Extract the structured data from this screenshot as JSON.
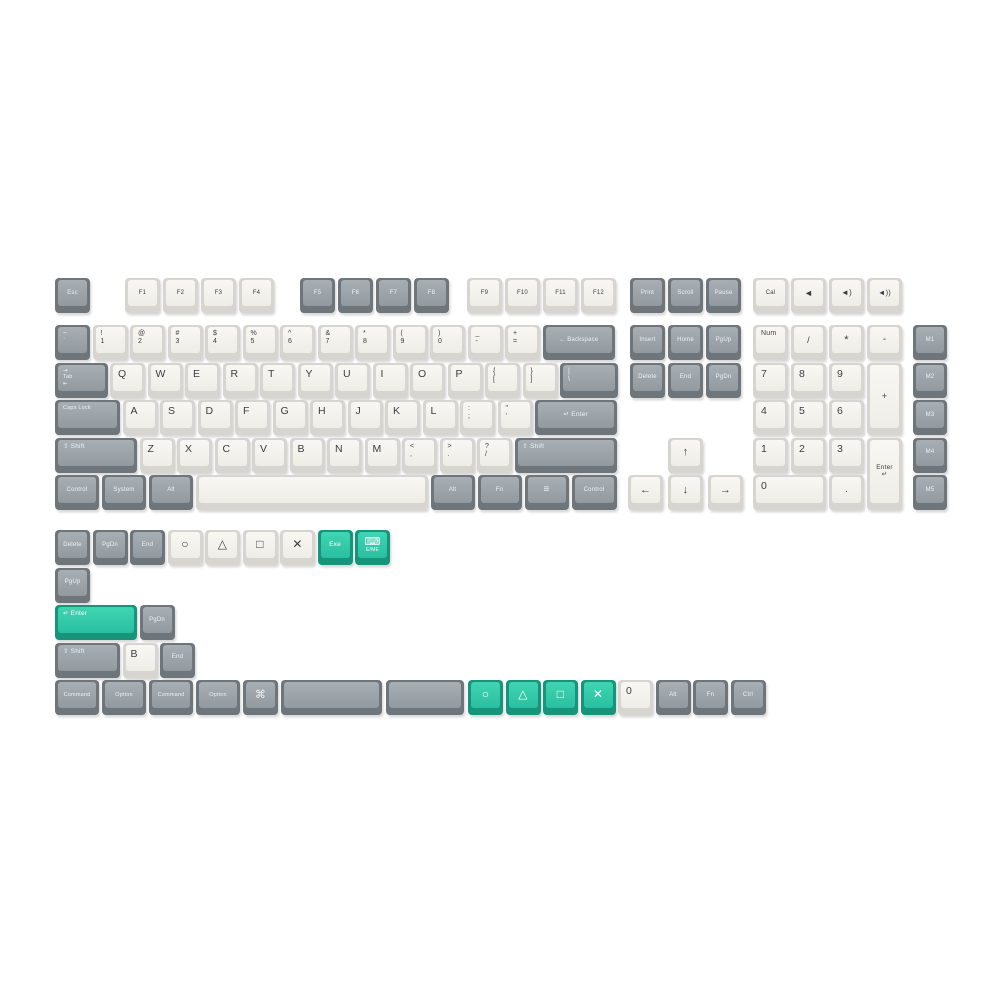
{
  "page": {
    "background": "#ffffff",
    "description_colors": {
      "white_key_top": "#f4f3ee",
      "white_key_side": "#d6d5cf",
      "gray_key_top": "#9aa1a7",
      "gray_key_side": "#6e757b",
      "teal_key_top": "#2fc8a6",
      "teal_key_side": "#17957a",
      "legend_dark": "#3b3e41",
      "legend_light": "#eef1f2"
    }
  },
  "keys": [
    {
      "id": "esc",
      "l": "Esc",
      "x": 55,
      "y": 278,
      "c": "gray"
    },
    {
      "id": "f1",
      "l": "F1",
      "x": 125,
      "y": 278,
      "c": "white"
    },
    {
      "id": "f2",
      "l": "F2",
      "x": 163,
      "y": 278,
      "c": "white"
    },
    {
      "id": "f3",
      "l": "F3",
      "x": 201,
      "y": 278,
      "c": "white"
    },
    {
      "id": "f4",
      "l": "F4",
      "x": 239,
      "y": 278,
      "c": "white"
    },
    {
      "id": "f5",
      "l": "F5",
      "x": 300,
      "y": 278,
      "c": "gray"
    },
    {
      "id": "f6",
      "l": "F6",
      "x": 338,
      "y": 278,
      "c": "gray"
    },
    {
      "id": "f7",
      "l": "F7",
      "x": 376,
      "y": 278,
      "c": "gray"
    },
    {
      "id": "f8",
      "l": "F8",
      "x": 414,
      "y": 278,
      "c": "gray"
    },
    {
      "id": "f9",
      "l": "F9",
      "x": 467,
      "y": 278,
      "c": "white"
    },
    {
      "id": "f10",
      "l": "F10",
      "x": 505,
      "y": 278,
      "c": "white"
    },
    {
      "id": "f11",
      "l": "F11",
      "x": 543,
      "y": 278,
      "c": "white"
    },
    {
      "id": "f12",
      "l": "F12",
      "x": 581,
      "y": 278,
      "c": "white"
    },
    {
      "id": "print",
      "l": "Print",
      "x": 630,
      "y": 278,
      "c": "gray"
    },
    {
      "id": "scroll",
      "l": "Scroll",
      "x": 668,
      "y": 278,
      "c": "gray"
    },
    {
      "id": "pause",
      "l": "Pause",
      "x": 706,
      "y": 278,
      "c": "gray"
    },
    {
      "id": "cal",
      "l": "Cal",
      "x": 753,
      "y": 278,
      "c": "white"
    },
    {
      "id": "vol-mute",
      "l": "◄",
      "x": 791,
      "y": 278,
      "c": "white",
      "a": "c",
      "fs": 9
    },
    {
      "id": "vol-down",
      "l": "◄)",
      "x": 829,
      "y": 278,
      "c": "white",
      "a": "c",
      "fs": 8
    },
    {
      "id": "vol-up",
      "l": "◄))",
      "x": 867,
      "y": 278,
      "c": "white",
      "a": "c",
      "fs": 7.5
    },
    {
      "id": "grave",
      "l": [
        "~",
        "`"
      ],
      "x": 55,
      "y": 325,
      "c": "gray"
    },
    {
      "id": "1",
      "l": [
        "!",
        "1"
      ],
      "x": 92.5,
      "y": 325,
      "c": "white"
    },
    {
      "id": "2",
      "l": [
        "@",
        "2"
      ],
      "x": 130,
      "y": 325,
      "c": "white"
    },
    {
      "id": "3",
      "l": [
        "#",
        "3"
      ],
      "x": 167.5,
      "y": 325,
      "c": "white"
    },
    {
      "id": "4",
      "l": [
        "$",
        "4"
      ],
      "x": 205,
      "y": 325,
      "c": "white"
    },
    {
      "id": "5",
      "l": [
        "%",
        "5"
      ],
      "x": 242.5,
      "y": 325,
      "c": "white"
    },
    {
      "id": "6",
      "l": [
        "^",
        "6"
      ],
      "x": 280,
      "y": 325,
      "c": "white"
    },
    {
      "id": "7",
      "l": [
        "&",
        "7"
      ],
      "x": 317.5,
      "y": 325,
      "c": "white"
    },
    {
      "id": "8",
      "l": [
        "*",
        "8"
      ],
      "x": 355,
      "y": 325,
      "c": "white"
    },
    {
      "id": "9",
      "l": [
        "(",
        "9"
      ],
      "x": 392.5,
      "y": 325,
      "c": "white"
    },
    {
      "id": "0",
      "l": [
        ")",
        "0"
      ],
      "x": 430,
      "y": 325,
      "c": "white"
    },
    {
      "id": "minus",
      "l": [
        "_",
        "-"
      ],
      "x": 467.5,
      "y": 325,
      "c": "white"
    },
    {
      "id": "equal",
      "l": [
        "+",
        "="
      ],
      "x": 505,
      "y": 325,
      "c": "white"
    },
    {
      "id": "backspace",
      "l": "← Backspace",
      "x": 542.5,
      "y": 325,
      "w": 72.5,
      "c": "gray"
    },
    {
      "id": "insert",
      "l": "Insert",
      "x": 630,
      "y": 325,
      "c": "gray"
    },
    {
      "id": "home",
      "l": "Home",
      "x": 668,
      "y": 325,
      "c": "gray"
    },
    {
      "id": "pgup",
      "l": "PgUp",
      "x": 706,
      "y": 325,
      "c": "gray"
    },
    {
      "id": "numlock",
      "l": "Num",
      "x": 753,
      "y": 325,
      "c": "white",
      "a": "l",
      "fs": 7
    },
    {
      "id": "np-div",
      "l": "/",
      "x": 791,
      "y": 325,
      "c": "white",
      "a": "c",
      "fs": 9
    },
    {
      "id": "np-mul",
      "l": "*",
      "x": 829,
      "y": 325,
      "c": "white",
      "a": "c",
      "fs": 11
    },
    {
      "id": "np-minus",
      "l": "-",
      "x": 867,
      "y": 325,
      "c": "white",
      "a": "c",
      "fs": 10
    },
    {
      "id": "m1",
      "l": "M1",
      "x": 913,
      "y": 325,
      "w": 34,
      "c": "gray"
    },
    {
      "id": "tab",
      "l": [
        "⇥",
        "Tab",
        "⇤"
      ],
      "x": 55,
      "y": 362.5,
      "w": 52.5,
      "c": "gray",
      "a": "l",
      "fs": 5.5
    },
    {
      "id": "q",
      "l": "Q",
      "x": 110,
      "y": 362.5,
      "c": "white"
    },
    {
      "id": "w",
      "l": "W",
      "x": 147.5,
      "y": 362.5,
      "c": "white"
    },
    {
      "id": "e",
      "l": "E",
      "x": 185,
      "y": 362.5,
      "c": "white"
    },
    {
      "id": "r",
      "l": "R",
      "x": 222.5,
      "y": 362.5,
      "c": "white"
    },
    {
      "id": "t",
      "l": "T",
      "x": 260,
      "y": 362.5,
      "c": "white"
    },
    {
      "id": "y",
      "l": "Y",
      "x": 297.5,
      "y": 362.5,
      "c": "white"
    },
    {
      "id": "u",
      "l": "U",
      "x": 335,
      "y": 362.5,
      "c": "white"
    },
    {
      "id": "i",
      "l": "I",
      "x": 372.5,
      "y": 362.5,
      "c": "white"
    },
    {
      "id": "o",
      "l": "O",
      "x": 410,
      "y": 362.5,
      "c": "white"
    },
    {
      "id": "p",
      "l": "P",
      "x": 447.5,
      "y": 362.5,
      "c": "white"
    },
    {
      "id": "lbracket",
      "l": [
        "{",
        "["
      ],
      "x": 485,
      "y": 362.5,
      "c": "white"
    },
    {
      "id": "rbracket",
      "l": [
        "}",
        "]"
      ],
      "x": 522.5,
      "y": 362.5,
      "c": "white"
    },
    {
      "id": "backslash",
      "l": [
        "|",
        "\\"
      ],
      "x": 560,
      "y": 362.5,
      "w": 57.5,
      "c": "gray"
    },
    {
      "id": "delete",
      "l": "Delete",
      "x": 630,
      "y": 362.5,
      "c": "gray"
    },
    {
      "id": "end",
      "l": "End",
      "x": 668,
      "y": 362.5,
      "c": "gray"
    },
    {
      "id": "pgdn",
      "l": "PgDn",
      "x": 706,
      "y": 362.5,
      "c": "gray"
    },
    {
      "id": "np7",
      "l": "7",
      "x": 753,
      "y": 362.5,
      "c": "white"
    },
    {
      "id": "np8",
      "l": "8",
      "x": 791,
      "y": 362.5,
      "c": "white"
    },
    {
      "id": "np9",
      "l": "9",
      "x": 829,
      "y": 362.5,
      "c": "white"
    },
    {
      "id": "np-plus",
      "l": "+",
      "x": 867,
      "y": 362.5,
      "h": 72.5,
      "c": "white",
      "a": "c",
      "fs": 9
    },
    {
      "id": "m2",
      "l": "M2",
      "x": 913,
      "y": 362.5,
      "w": 34,
      "c": "gray"
    },
    {
      "id": "capslock",
      "l": "Caps Lock",
      "x": 55,
      "y": 400,
      "w": 65,
      "c": "gray",
      "a": "l",
      "fs": 5.5
    },
    {
      "id": "a",
      "l": "A",
      "x": 122.5,
      "y": 400,
      "c": "white"
    },
    {
      "id": "s",
      "l": "S",
      "x": 160,
      "y": 400,
      "c": "white"
    },
    {
      "id": "d",
      "l": "D",
      "x": 197.5,
      "y": 400,
      "c": "white"
    },
    {
      "id": "f",
      "l": "F",
      "x": 235,
      "y": 400,
      "c": "white"
    },
    {
      "id": "g",
      "l": "G",
      "x": 272.5,
      "y": 400,
      "c": "white"
    },
    {
      "id": "h",
      "l": "H",
      "x": 310,
      "y": 400,
      "c": "white"
    },
    {
      "id": "j",
      "l": "J",
      "x": 347.5,
      "y": 400,
      "c": "white"
    },
    {
      "id": "k",
      "l": "K",
      "x": 385,
      "y": 400,
      "c": "white"
    },
    {
      "id": "l",
      "l": "L",
      "x": 422.5,
      "y": 400,
      "c": "white"
    },
    {
      "id": "semicolon",
      "l": [
        ":",
        ";"
      ],
      "x": 460,
      "y": 400,
      "c": "white"
    },
    {
      "id": "quote",
      "l": [
        "\"",
        "'"
      ],
      "x": 497.5,
      "y": 400,
      "c": "white"
    },
    {
      "id": "enter",
      "l": "↵ Enter",
      "x": 535,
      "y": 400,
      "w": 81.5,
      "c": "gray",
      "fs": 6.5
    },
    {
      "id": "np4",
      "l": "4",
      "x": 753,
      "y": 400,
      "c": "white"
    },
    {
      "id": "np5",
      "l": "5",
      "x": 791,
      "y": 400,
      "c": "white"
    },
    {
      "id": "np6",
      "l": "6",
      "x": 829,
      "y": 400,
      "c": "white"
    },
    {
      "id": "m3",
      "l": "M3",
      "x": 913,
      "y": 400,
      "w": 34,
      "c": "gray"
    },
    {
      "id": "lshift",
      "l": "⇧ Shift",
      "x": 55,
      "y": 437.5,
      "w": 81.5,
      "c": "gray",
      "a": "l",
      "fs": 6.5
    },
    {
      "id": "z",
      "l": "Z",
      "x": 139.5,
      "y": 437.5,
      "c": "white"
    },
    {
      "id": "x",
      "l": "X",
      "x": 177,
      "y": 437.5,
      "c": "white"
    },
    {
      "id": "c",
      "l": "C",
      "x": 214.5,
      "y": 437.5,
      "c": "white"
    },
    {
      "id": "v",
      "l": "V",
      "x": 252,
      "y": 437.5,
      "c": "white"
    },
    {
      "id": "b",
      "l": "B",
      "x": 289.5,
      "y": 437.5,
      "c": "white"
    },
    {
      "id": "n",
      "l": "N",
      "x": 327,
      "y": 437.5,
      "c": "white"
    },
    {
      "id": "m",
      "l": "M",
      "x": 364.5,
      "y": 437.5,
      "c": "white"
    },
    {
      "id": "comma",
      "l": [
        "<",
        ","
      ],
      "x": 402,
      "y": 437.5,
      "c": "white"
    },
    {
      "id": "period",
      "l": [
        ">",
        "."
      ],
      "x": 439.5,
      "y": 437.5,
      "c": "white"
    },
    {
      "id": "slash",
      "l": [
        "?",
        "/"
      ],
      "x": 477,
      "y": 437.5,
      "c": "white"
    },
    {
      "id": "rshift",
      "l": "⇧ Shift",
      "x": 514.5,
      "y": 437.5,
      "w": 102,
      "c": "gray",
      "a": "l",
      "fs": 6.5
    },
    {
      "id": "arrow-up",
      "l": "↑",
      "x": 668,
      "y": 437.5,
      "c": "white",
      "a": "c",
      "fs": 11
    },
    {
      "id": "np1",
      "l": "1",
      "x": 753,
      "y": 437.5,
      "c": "white"
    },
    {
      "id": "np2",
      "l": "2",
      "x": 791,
      "y": 437.5,
      "c": "white"
    },
    {
      "id": "np3",
      "l": "3",
      "x": 829,
      "y": 437.5,
      "c": "white"
    },
    {
      "id": "np-enter",
      "l": [
        "Enter",
        "↵"
      ],
      "x": 867,
      "y": 437.5,
      "h": 72.5,
      "c": "white",
      "a": "c",
      "fs": 6.5
    },
    {
      "id": "m4",
      "l": "M4",
      "x": 913,
      "y": 437.5,
      "w": 34,
      "c": "gray"
    },
    {
      "id": "lcontrol",
      "l": "Control",
      "x": 55,
      "y": 475,
      "w": 44,
      "c": "gray"
    },
    {
      "id": "system",
      "l": "System",
      "x": 102,
      "y": 475,
      "w": 44,
      "c": "gray"
    },
    {
      "id": "lalt",
      "l": "Alt",
      "x": 149,
      "y": 475,
      "w": 44,
      "c": "gray"
    },
    {
      "id": "space",
      "l": "",
      "x": 196,
      "y": 475,
      "w": 232,
      "c": "white"
    },
    {
      "id": "ralt",
      "l": "Alt",
      "x": 430.5,
      "y": 475,
      "w": 44,
      "c": "gray"
    },
    {
      "id": "fn",
      "l": "Fn",
      "x": 477.5,
      "y": 475,
      "w": 44,
      "c": "gray"
    },
    {
      "id": "menu",
      "l": "≡",
      "x": 524.5,
      "y": 475,
      "w": 44,
      "c": "gray",
      "a": "c",
      "fs": 10
    },
    {
      "id": "rcontrol",
      "l": "Control",
      "x": 571.5,
      "y": 475,
      "w": 45,
      "c": "gray"
    },
    {
      "id": "arrow-left",
      "l": "←",
      "x": 628,
      "y": 475,
      "c": "white",
      "a": "c",
      "fs": 11
    },
    {
      "id": "arrow-down",
      "l": "↓",
      "x": 668,
      "y": 475,
      "c": "white",
      "a": "c",
      "fs": 11
    },
    {
      "id": "arrow-right",
      "l": "→",
      "x": 708,
      "y": 475,
      "c": "white",
      "a": "c",
      "fs": 11
    },
    {
      "id": "np0",
      "l": "0",
      "x": 753,
      "y": 475,
      "w": 72.5,
      "c": "white"
    },
    {
      "id": "np-dot",
      "l": ".",
      "x": 829,
      "y": 475,
      "c": "white",
      "a": "c",
      "fs": 10
    },
    {
      "id": "m5",
      "l": "M5",
      "x": 913,
      "y": 475,
      "w": 34,
      "c": "gray"
    },
    {
      "id": "x-delete",
      "l": "Delete",
      "x": 55,
      "y": 530,
      "c": "gray"
    },
    {
      "id": "x-pgdn",
      "l": "PgDn",
      "x": 92.5,
      "y": 530,
      "c": "gray"
    },
    {
      "id": "x-end",
      "l": "End",
      "x": 130,
      "y": 530,
      "c": "gray"
    },
    {
      "id": "ps-circle",
      "l": "○",
      "x": 167.5,
      "y": 530,
      "c": "white",
      "a": "c",
      "fs": 12
    },
    {
      "id": "ps-triangle",
      "l": "△",
      "x": 205,
      "y": 530,
      "c": "white",
      "a": "c",
      "fs": 12
    },
    {
      "id": "ps-square",
      "l": "□",
      "x": 242.5,
      "y": 530,
      "c": "white",
      "a": "c",
      "fs": 12
    },
    {
      "id": "ps-cross",
      "l": "✕",
      "x": 280,
      "y": 530,
      "c": "white",
      "a": "c",
      "fs": 12
    },
    {
      "id": "exe",
      "l": "Exe",
      "x": 317.5,
      "y": 530,
      "c": "teal",
      "a": "c",
      "fs": 6.5
    },
    {
      "id": "keyboard-lang",
      "l": [
        "⌨",
        "E/ME"
      ],
      "x": 355,
      "y": 530,
      "c": "teal",
      "a": "c",
      "fs": 5,
      "cls": "kbdicon"
    },
    {
      "id": "x-pgup",
      "l": "PgUp",
      "x": 55,
      "y": 567.5,
      "c": "gray"
    },
    {
      "id": "x-enter-teal",
      "l": "↵ Enter",
      "x": 55,
      "y": 605,
      "w": 81.5,
      "c": "teal",
      "a": "l",
      "fs": 6.5
    },
    {
      "id": "x-pgdn2",
      "l": "PgDn",
      "x": 139.5,
      "y": 605,
      "c": "gray"
    },
    {
      "id": "x-shift",
      "l": "⇧ Shift",
      "x": 55,
      "y": 642.5,
      "w": 65,
      "c": "gray",
      "a": "l",
      "fs": 6.5
    },
    {
      "id": "x-b",
      "l": "B",
      "x": 122.5,
      "y": 642.5,
      "c": "white"
    },
    {
      "id": "x-end2",
      "l": "End",
      "x": 160,
      "y": 642.5,
      "c": "gray"
    },
    {
      "id": "command1",
      "l": "Command",
      "x": 55,
      "y": 680,
      "w": 44,
      "c": "gray",
      "fs": 5.5
    },
    {
      "id": "option1",
      "l": "Option",
      "x": 102,
      "y": 680,
      "w": 44,
      "c": "gray",
      "fs": 5.5
    },
    {
      "id": "command2",
      "l": "Command",
      "x": 149,
      "y": 680,
      "w": 44,
      "c": "gray",
      "fs": 5.5
    },
    {
      "id": "option2",
      "l": "Option",
      "x": 196,
      "y": 680,
      "w": 44,
      "c": "gray",
      "fs": 5.5
    },
    {
      "id": "cmd-symbol",
      "l": "⌘",
      "x": 243,
      "y": 680,
      "c": "gray",
      "a": "c",
      "fs": 11
    },
    {
      "id": "blank-wide1",
      "l": "",
      "x": 280.5,
      "y": 680,
      "w": 101,
      "c": "gray"
    },
    {
      "id": "blank-wide2",
      "l": "",
      "x": 386,
      "y": 680,
      "w": 78,
      "c": "gray"
    },
    {
      "id": "teal-circle",
      "l": "○",
      "x": 468,
      "y": 680,
      "c": "teal",
      "a": "c",
      "fs": 12
    },
    {
      "id": "teal-triangle",
      "l": "△",
      "x": 505.5,
      "y": 680,
      "c": "teal",
      "a": "c",
      "fs": 12
    },
    {
      "id": "teal-square",
      "l": "□",
      "x": 543,
      "y": 680,
      "c": "teal",
      "a": "c",
      "fs": 12
    },
    {
      "id": "teal-cross",
      "l": "✕",
      "x": 580.5,
      "y": 680,
      "c": "teal",
      "a": "c",
      "fs": 12
    },
    {
      "id": "x-zero",
      "l": "0",
      "x": 618,
      "y": 680,
      "c": "white"
    },
    {
      "id": "x-alt",
      "l": "Alt",
      "x": 655.5,
      "y": 680,
      "c": "gray"
    },
    {
      "id": "x-fn",
      "l": "Fn",
      "x": 693,
      "y": 680,
      "c": "gray"
    },
    {
      "id": "x-ctrl",
      "l": "Ctrl",
      "x": 730.5,
      "y": 680,
      "c": "gray"
    }
  ]
}
